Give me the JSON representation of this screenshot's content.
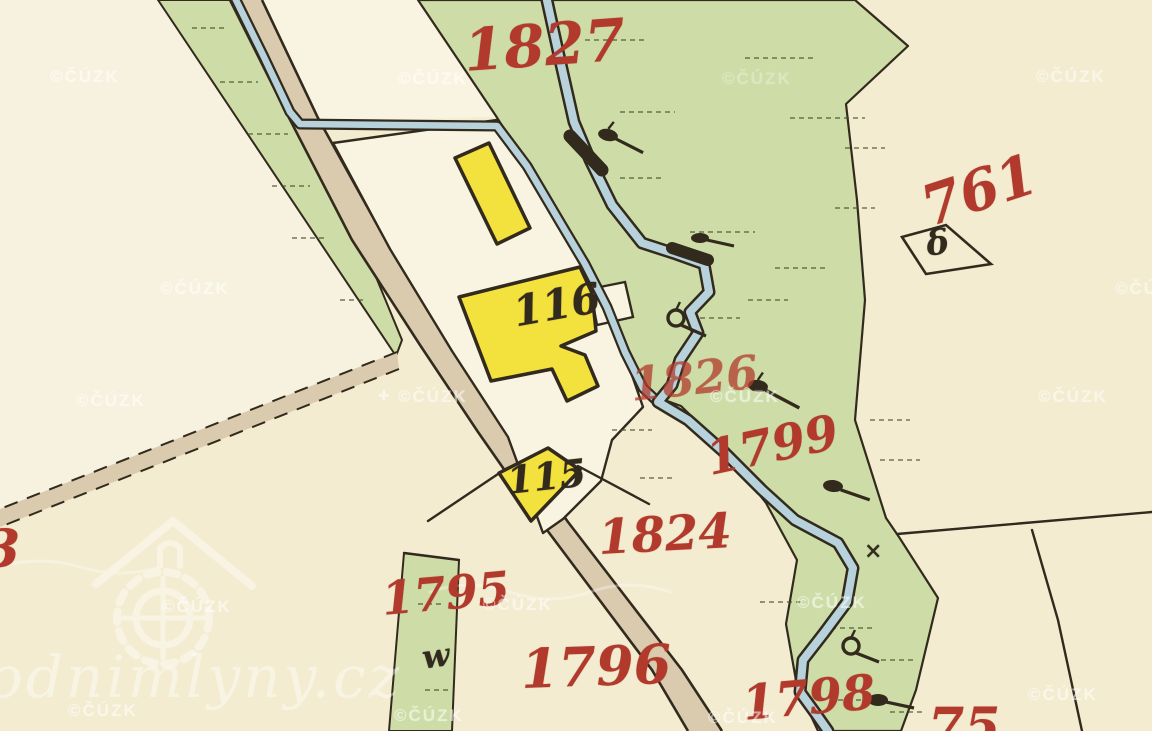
{
  "watermark": {
    "small": "©ČÚZK",
    "plus": "+",
    "domain": "odnimlyny.cz"
  },
  "labels": {
    "parcels": {
      "n1827": "1827",
      "n761": "761",
      "n1826": "1826",
      "n1799": "1799",
      "n1824": "1824",
      "n1795": "1795",
      "n1796": "1796",
      "n1798": "1798",
      "n75_partial": "75",
      "n3_partial": "3"
    },
    "buildings": {
      "b116": "116",
      "b115": "115"
    },
    "symbols": {
      "delta": "δ",
      "meadow": "w",
      "cross": "×"
    }
  },
  "colors": {
    "paper": "#f3ecd0",
    "parcel-white": "#f9f4e2",
    "green": "#cedda7",
    "green-light": "#f7f2df",
    "road": "#dacaae",
    "water": "#b7d2da",
    "ink": "#332a1e",
    "label-red": "#b23a2c",
    "building-yellow": "#f3e13e",
    "watermark": "#ffffff"
  }
}
